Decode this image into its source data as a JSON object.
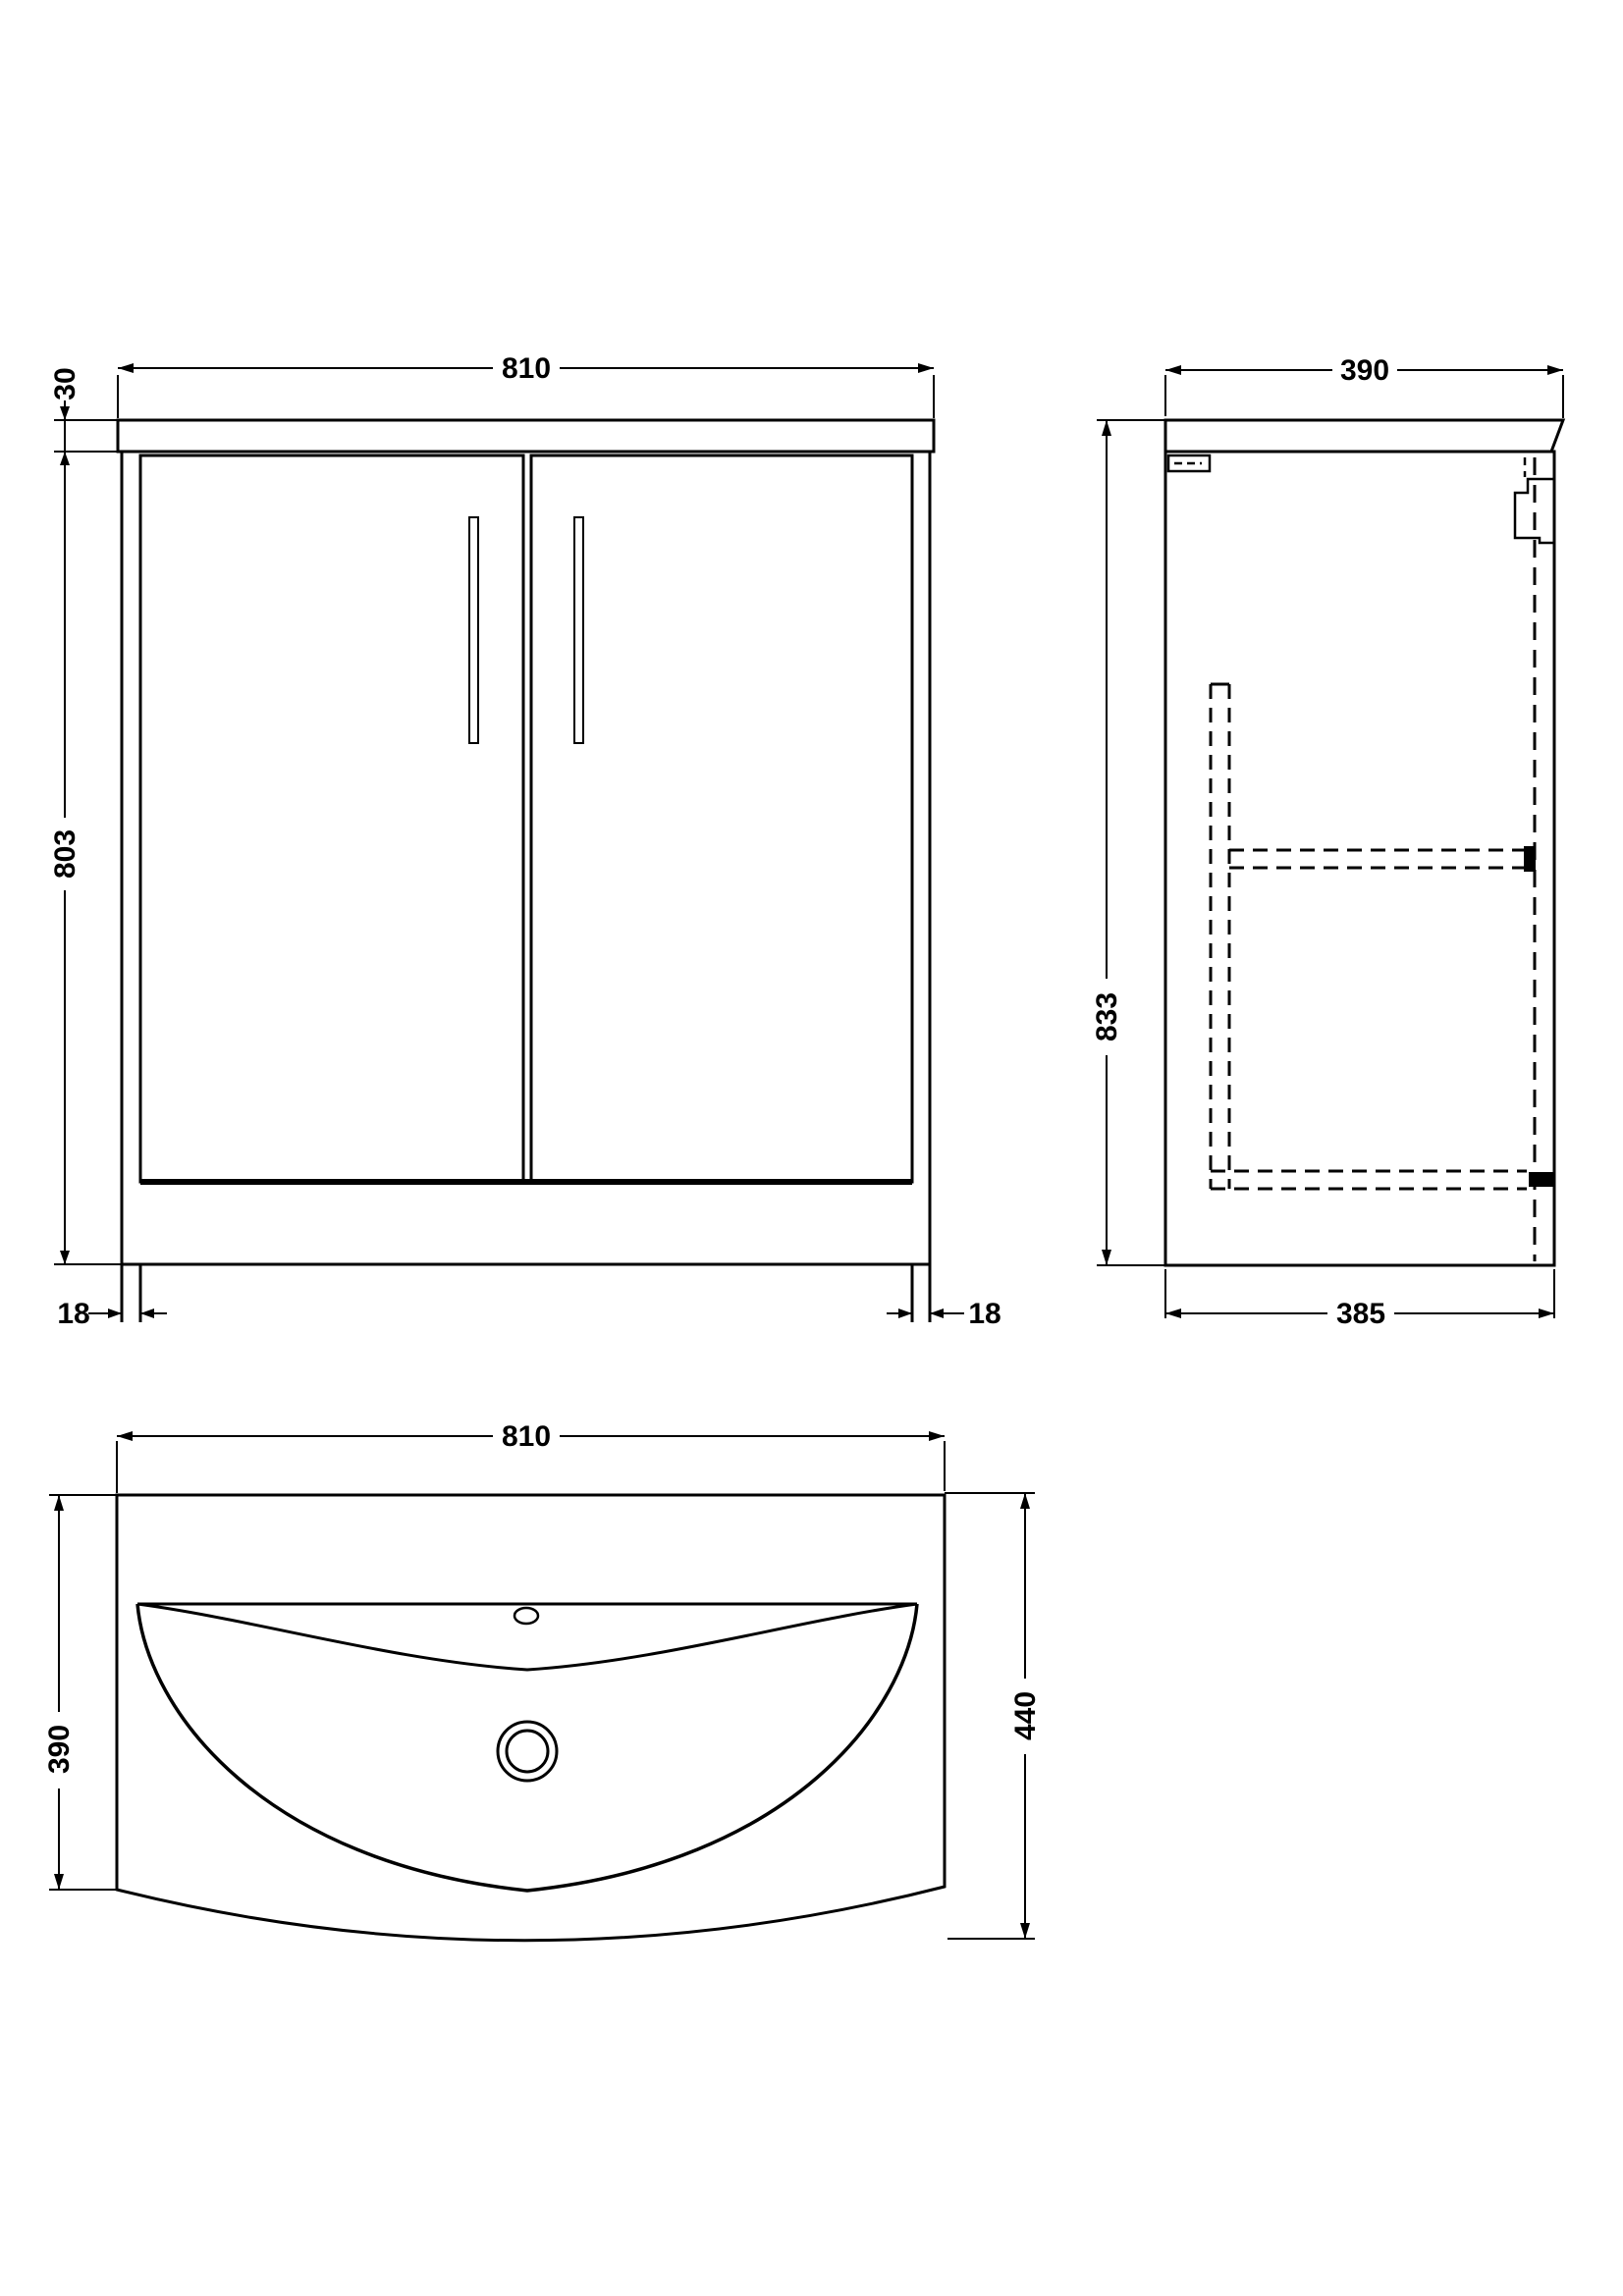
{
  "drawing": {
    "type": "technical-drawing",
    "subject": "vanity unit with basin",
    "background_color": "#ffffff",
    "line_color": "#000000"
  },
  "views": {
    "front": {
      "width": "810",
      "top_thickness": "30",
      "height": "803",
      "leg_left": "18",
      "leg_right": "18"
    },
    "side": {
      "depth": "390",
      "height": "833",
      "base_depth": "385"
    },
    "basin": {
      "width": "810",
      "depth": "390",
      "total_depth": "440"
    }
  }
}
